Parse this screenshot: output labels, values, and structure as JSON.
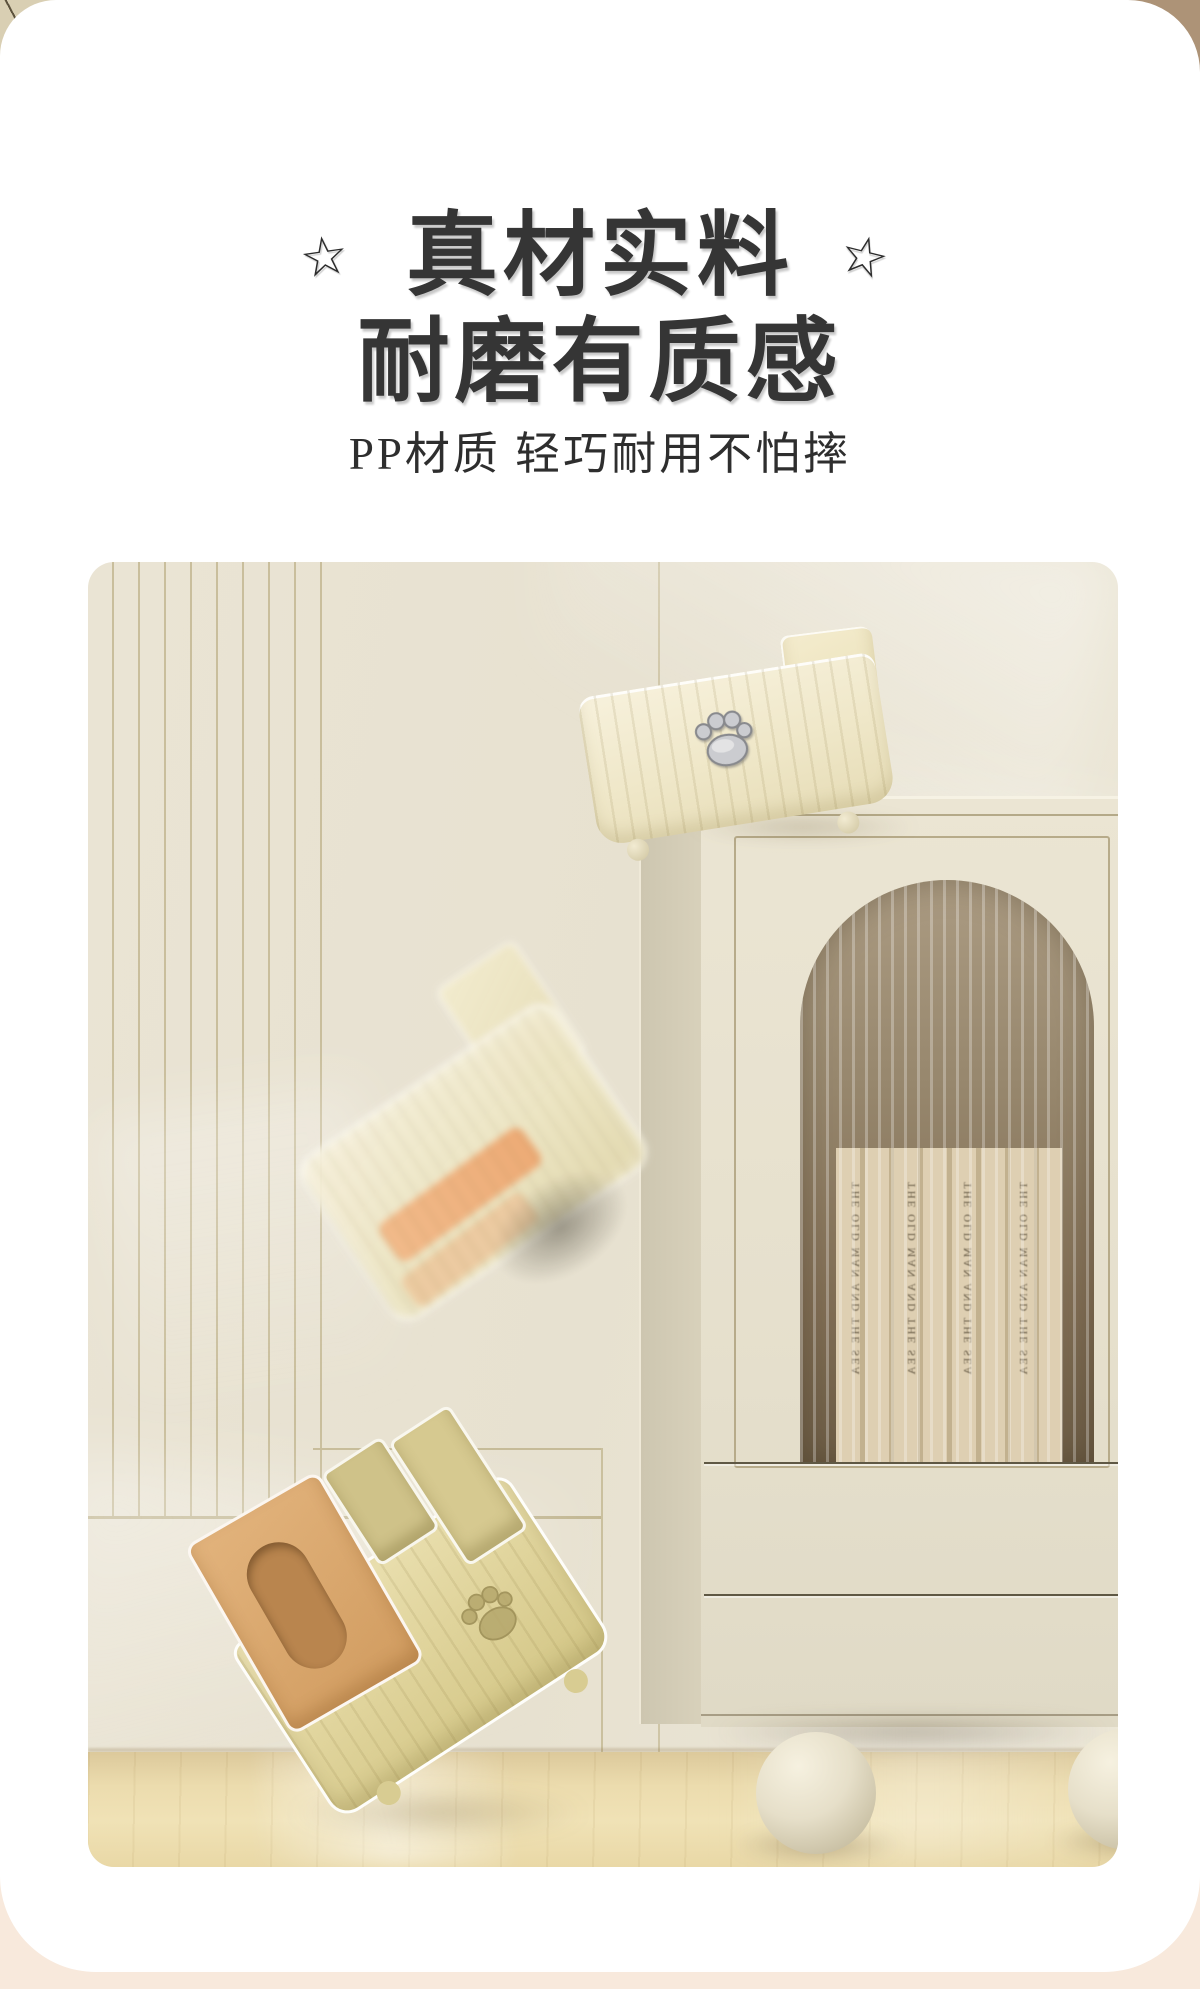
{
  "header": {
    "title_line1": "真材实料",
    "title_line2": "耐磨有质感",
    "subtitle": "PP材质 轻巧耐用不怕摔",
    "star_glyph": "☆",
    "text_color": "#353535"
  },
  "photo": {
    "book_spine_text": "THE OLD MAN AND THE SEA"
  },
  "colors": {
    "page_background": "#f8e9dc",
    "card": "#ffffff",
    "backdrop_top_left": "#d9cfb3",
    "backdrop_top_right": "#ad9377",
    "wall_cream": "#e9e3d2",
    "panel_line": "#c9be9c",
    "cabinet_front": "#e6e0cd",
    "arch_glass": "#8d7c64",
    "floor_wood": "#ecdcae",
    "box_cream": "#efe7c8",
    "box_khaki": "#ddd196",
    "lid_tan": "#d8a768",
    "tissue_orange": "#eeaa74",
    "paw_silver": "#cbccd0"
  }
}
